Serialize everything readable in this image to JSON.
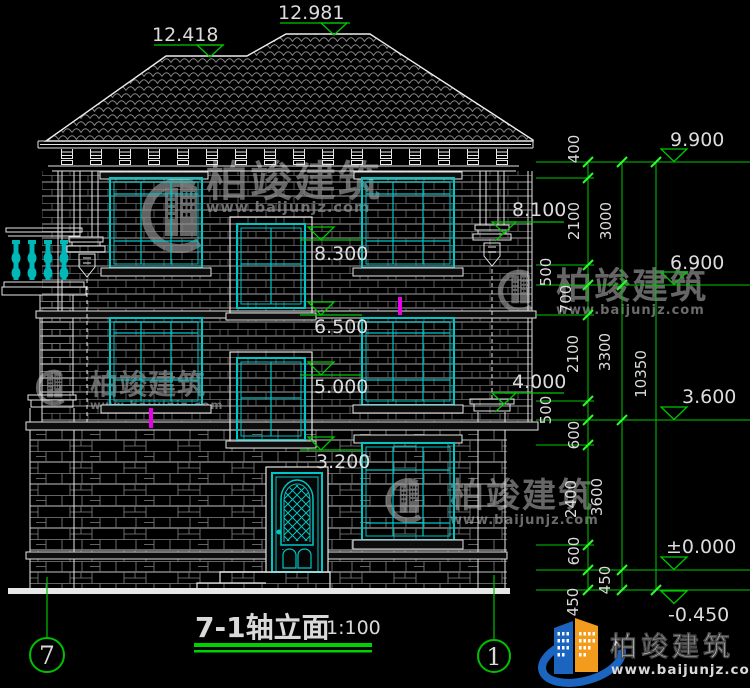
{
  "title_block": {
    "title": "7-1轴立面",
    "scale": "1:100"
  },
  "axis_bubbles": {
    "left": "7",
    "right": "1"
  },
  "roof_marks": {
    "left": "12.418",
    "right": "12.981"
  },
  "level_marks": {
    "right_side": [
      "9.900",
      "6.900",
      "3.600",
      "±0.000",
      "-0.450"
    ],
    "facade": [
      "8.300",
      "6.500",
      "5.000",
      "3.200"
    ],
    "facade_right": [
      "8.100",
      "4.000"
    ]
  },
  "dimensions": {
    "inner_chain": [
      "400",
      "2100",
      "500",
      "700",
      "2100",
      "500",
      "600",
      "2400",
      "600",
      "450"
    ],
    "middle_chain": [
      "3000",
      "3300",
      "3600",
      "450"
    ],
    "overall": "10350"
  },
  "watermark": {
    "brand": "柏竣建筑",
    "website": "www.baijunjz.com"
  },
  "logo": {
    "brand": "柏竣建筑",
    "website": "www.baijunjz.com"
  },
  "colors": {
    "background": "#000000",
    "line_white": "#e6e6e6",
    "window_cyan": "#00c6c6",
    "dim_green": "#00c800",
    "tick_green": "#2aff2a",
    "text_gray": "#d9d9d9",
    "magenta": "#e800e8",
    "logo_blue": "#1b64c0",
    "logo_orange": "#f29b1d",
    "watermark_gray": "#757575"
  }
}
